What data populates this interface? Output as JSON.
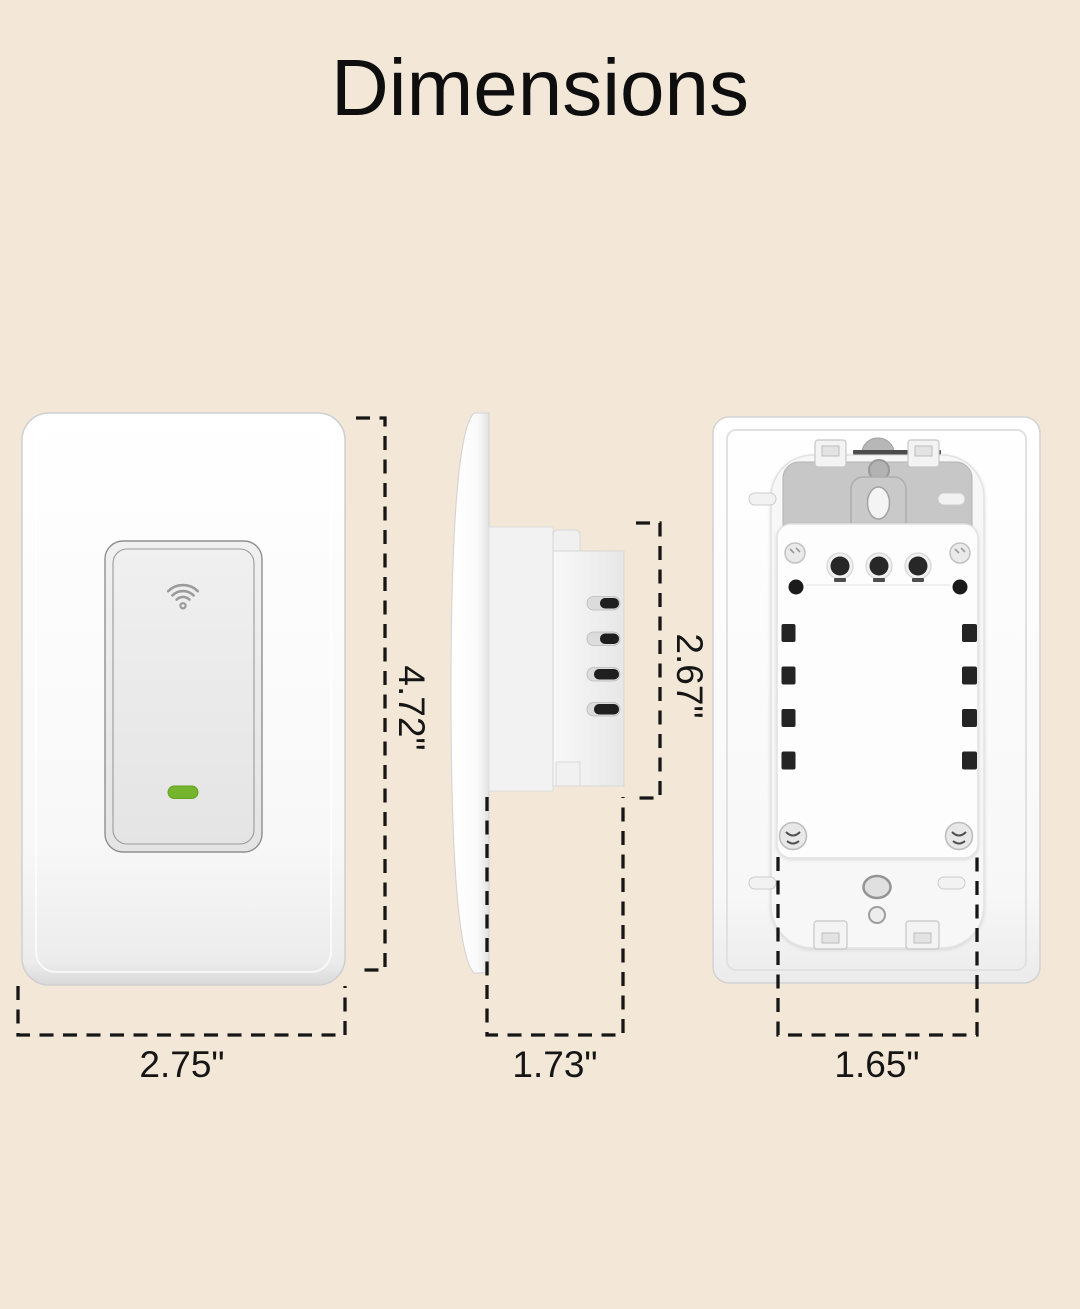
{
  "title": "Dimensions",
  "labels": {
    "front_height": "4.72\"",
    "front_width": "2.75\"",
    "side_body_height": "2.67\"",
    "side_depth": "1.73\"",
    "back_width": "1.65\""
  },
  "icons": {
    "wifi": "wifi-icon",
    "led": "led-indicator"
  },
  "colors": {
    "background": "#f3e8d8",
    "text": "#151515",
    "led_green": "#74b52d",
    "dimension_line": "#161616"
  }
}
